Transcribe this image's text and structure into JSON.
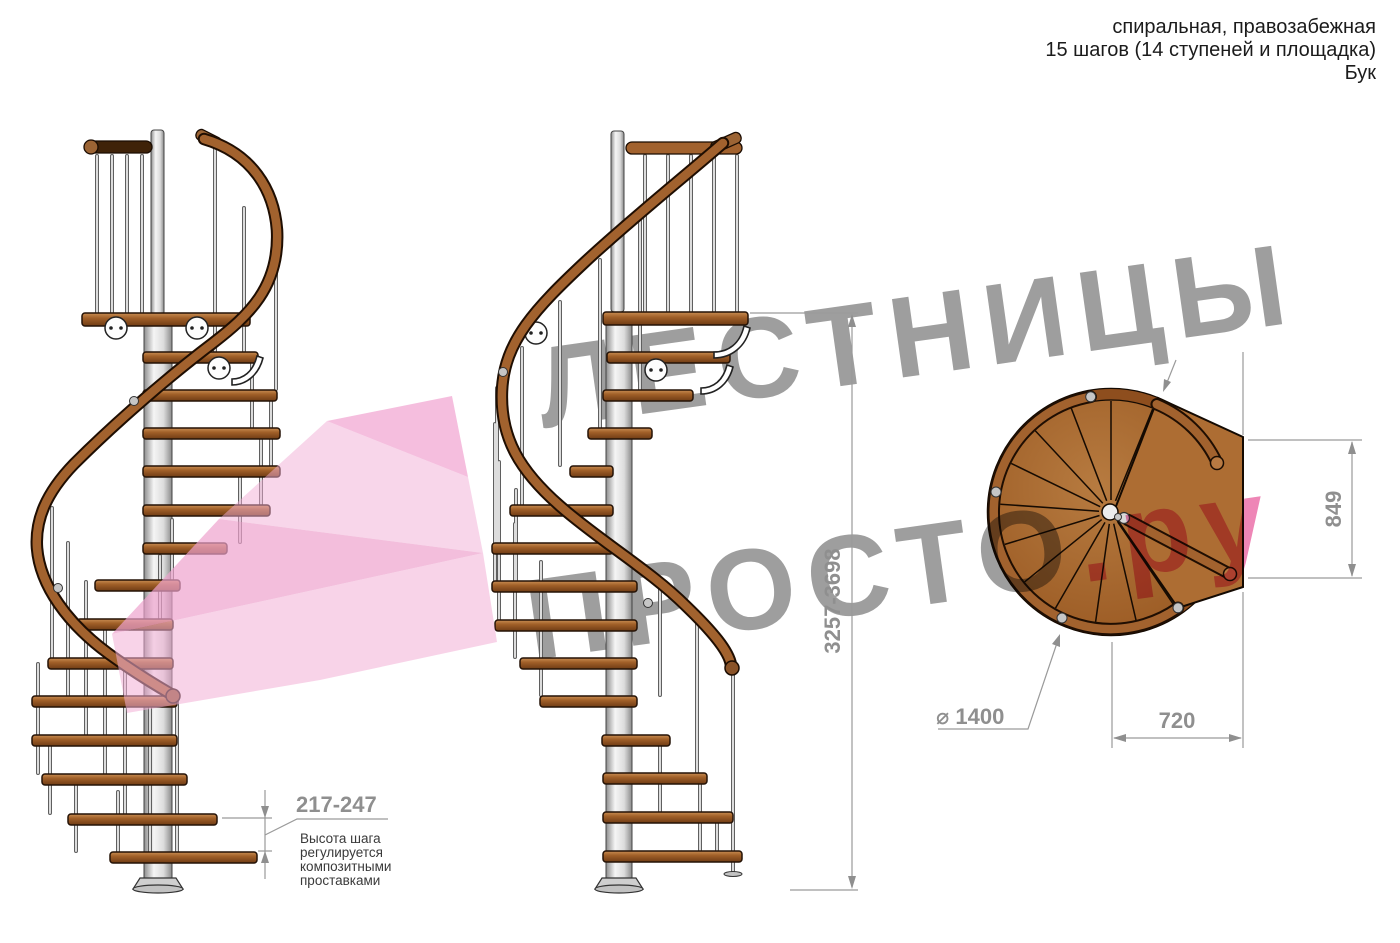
{
  "header": {
    "line1": "спиральная, правозабежная",
    "line2": "15 шагов (14 ступеней и площадка)",
    "line3": "Бук"
  },
  "watermark": {
    "row1": "ЛЕСТНИЦЫ",
    "row2_main": "ПРОСТО",
    "row2_suffix": ".ру",
    "grey": "#9e9e9e",
    "pink": "#ee86b6"
  },
  "dimensions": {
    "total_height": "3257-3698",
    "step_height": "217-247",
    "diameter": "⌀ 1400",
    "landing_depth": "849",
    "landing_width": "720"
  },
  "note": {
    "line1": "Высота шага",
    "line2": "регулируется",
    "line3": "композитными",
    "line4": "проставками"
  },
  "colors": {
    "wood": "#a96a30",
    "rail_brown": "#a2622e",
    "steel": "#d9d9d9",
    "dimension_grey": "#8f8f8f",
    "highlight_pink": "#f2aed6"
  }
}
